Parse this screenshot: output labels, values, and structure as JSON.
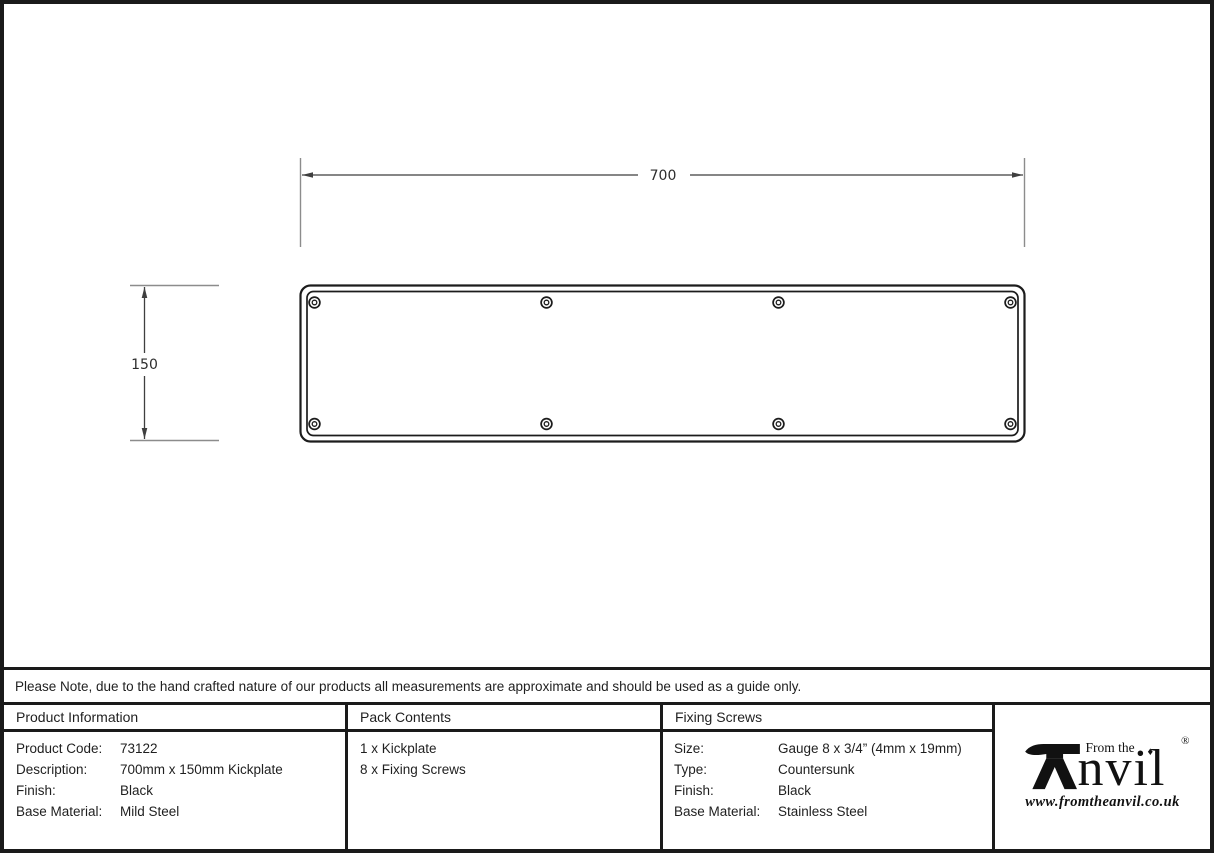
{
  "note": {
    "text": "Please Note, due to the hand crafted nature of our products all measurements are approximate and should be used as a guide only."
  },
  "drawing": {
    "width_label": "700",
    "height_label": "150"
  },
  "table": {
    "product_information": {
      "header": "Product Information",
      "rows": [
        {
          "label": "Product Code:",
          "value": "73122"
        },
        {
          "label": "Description:",
          "value": "700mm x 150mm Kickplate"
        },
        {
          "label": "Finish:",
          "value": "Black"
        },
        {
          "label": "Base Material:",
          "value": "Mild Steel"
        }
      ]
    },
    "pack_contents": {
      "header": "Pack Contents",
      "items": [
        {
          "text": "1 x Kickplate"
        },
        {
          "text": "8 x Fixing Screws"
        }
      ]
    },
    "fixing_screws": {
      "header": "Fixing Screws",
      "rows": [
        {
          "label": "Size:",
          "value": "Gauge 8 x 3/4” (4mm x 19mm)"
        },
        {
          "label": "Type:",
          "value": "Countersunk"
        },
        {
          "label": "Finish:",
          "value": "Black"
        },
        {
          "label": "Base Material:",
          "value": "Stainless Steel"
        }
      ]
    }
  },
  "logo": {
    "tagline": "From the",
    "brand": "nvil",
    "registered": "®",
    "diamond": "♦",
    "website": "www.fromtheanvil.co.uk"
  }
}
